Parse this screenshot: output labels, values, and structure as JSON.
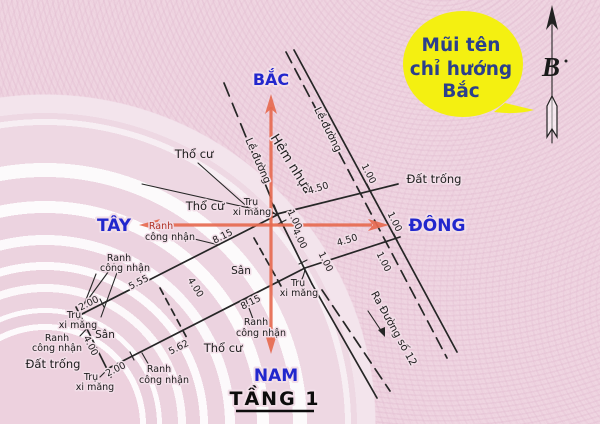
{
  "compass": {
    "north": "BẮC",
    "south": "NAM",
    "east": "ĐÔNG",
    "west": "TÂY"
  },
  "callout": {
    "line1": "Mũi tên",
    "line2": "chỉ hướng",
    "line3": "Bắc"
  },
  "north_indicator": {
    "letter": "B"
  },
  "title": {
    "text": "TẦNG 1"
  },
  "roads": {
    "alley": "Hẻm nhựa",
    "edge": "Lề đường",
    "exit": "Ra Đường số 12"
  },
  "areas": {
    "residential": "Thổ cư",
    "yard": "Sân",
    "vacant": "Đất trống"
  },
  "markers": {
    "pillar_line1": "Trụ",
    "pillar_line2": "xi măng",
    "boundary_line1": "Ranh",
    "boundary_line2": "công nhận"
  },
  "dimensions": {
    "d100": "1.00",
    "d200": "2.00",
    "d400": "4.00",
    "d450": "4.50",
    "d555": "5.55",
    "d562": "5.62",
    "d815": "8.15"
  },
  "colors": {
    "paper": "#efd5e1",
    "ink": "#262626",
    "compass_blue": "#2227cd",
    "arrow_red": "#e66a50",
    "callout_yellow": "#f4f011",
    "callout_text": "#2b3f8c",
    "ranh_red": "#b03226"
  }
}
